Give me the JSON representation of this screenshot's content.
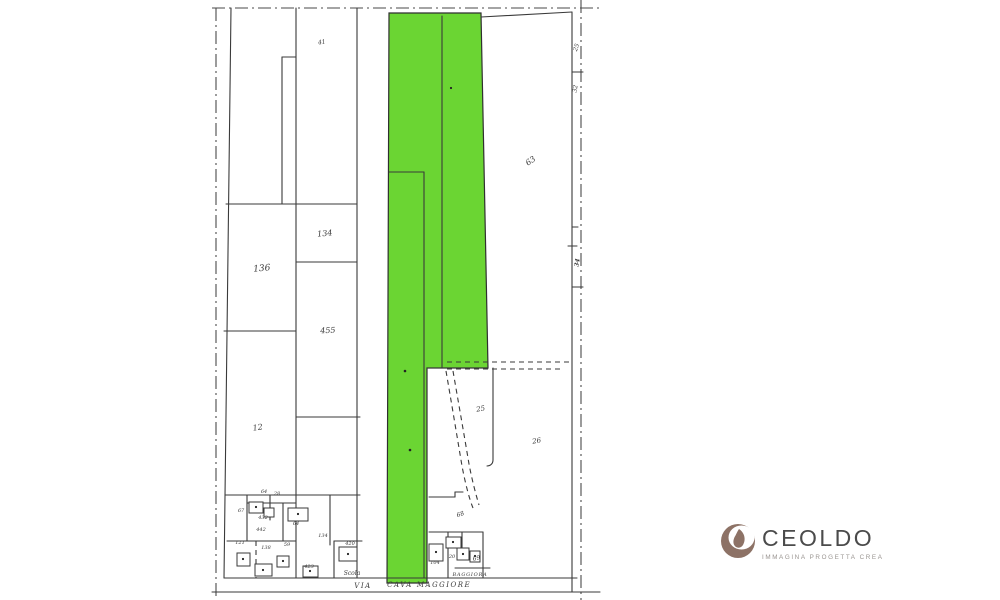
{
  "map": {
    "parcel_labels": [
      {
        "text": "41"
      },
      {
        "text": "134"
      },
      {
        "text": "136"
      },
      {
        "text": "455"
      },
      {
        "text": "12"
      },
      {
        "text": "63"
      },
      {
        "text": "25"
      },
      {
        "text": "26"
      },
      {
        "text": "68"
      },
      {
        "text": "69"
      },
      {
        "text": "104"
      },
      {
        "text": "20"
      }
    ],
    "strip_labels": [
      {
        "text": "25"
      },
      {
        "text": "32"
      },
      {
        "text": "34"
      }
    ],
    "cluster_labels": [
      {
        "text": "64"
      },
      {
        "text": "28"
      },
      {
        "text": "67"
      },
      {
        "text": "432"
      },
      {
        "text": "442"
      },
      {
        "text": "64"
      },
      {
        "text": "134"
      },
      {
        "text": "121"
      },
      {
        "text": "138"
      },
      {
        "text": "59"
      },
      {
        "text": "420"
      },
      {
        "text": "423"
      }
    ],
    "locality_labels": [
      {
        "text": "Scola"
      },
      {
        "text": "BAGGIORA"
      }
    ],
    "road_labels": [
      {
        "text": "VIA"
      },
      {
        "text": "CAVA"
      },
      {
        "text": "MAGGIORE"
      }
    ]
  },
  "logo": {
    "name": "CEOLDO",
    "tagline": "IMMAGINA PROGETTA CREA"
  },
  "colors": {
    "highlight_green": "#5bd01d",
    "logo_brown": "#8d7266",
    "logo_text": "#4b4b4b",
    "map_line": "#3a3a3a"
  }
}
